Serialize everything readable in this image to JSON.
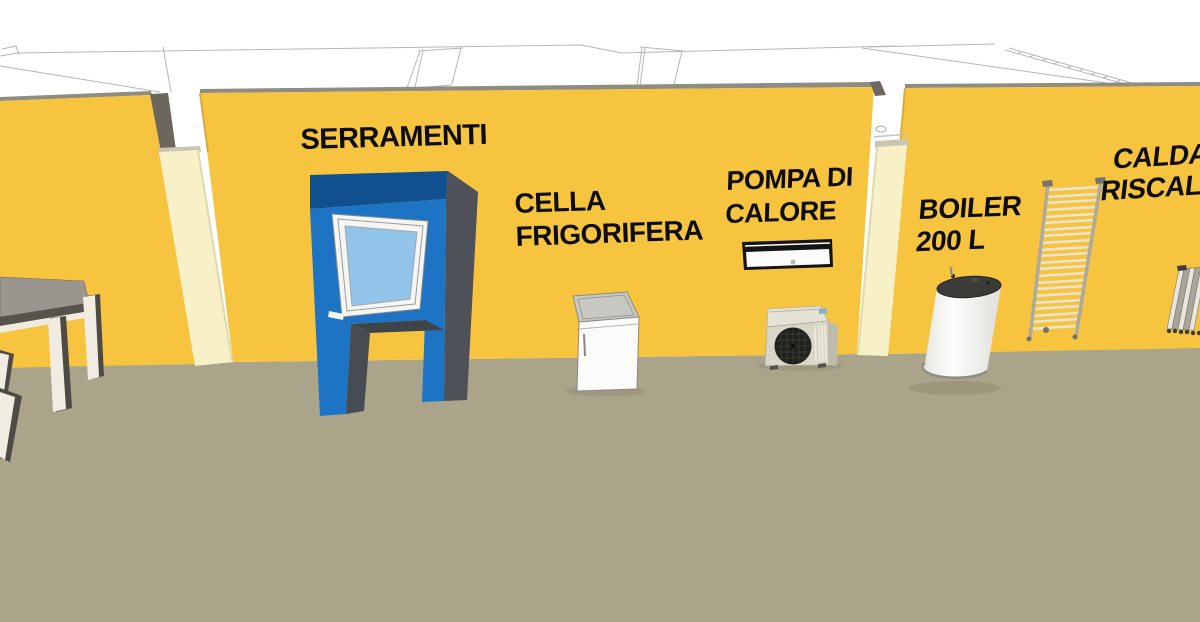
{
  "labels": {
    "serramenti": {
      "line1": "SERRAMENTI"
    },
    "cella_frigorifera": {
      "line1": "CELLA",
      "line2": "FRIGORIFERA"
    },
    "pompa_di_calore": {
      "line1": "POMPA DI",
      "line2": "CALORE"
    },
    "boiler": {
      "line1": "BOILER",
      "line2": "200 L"
    },
    "caldaia_riscaldamento_truncated": {
      "line1": "CALDA",
      "line2": "RISCAL"
    }
  },
  "colors": {
    "background": "#FFFFFF",
    "wall_yellow": "#F7C43F",
    "wall_cap_gray": "#8F8D82",
    "ground_olive": "#AAA48A",
    "pillar_cream": "#F8F1C8",
    "stand_blue_front": "#1E74C4",
    "stand_blue_top": "#11508F",
    "window_glass_blue": "#92C3E9",
    "label_text": "#0D0D0D",
    "roof_outline_gray": "#B6B6B6"
  },
  "scene_objects": [
    "exhibit-table",
    "window-display-stand",
    "cold-room-cabinet",
    "heat-pump-indoor-unit",
    "heat-pump-outdoor-unit",
    "boiler-tank-200l",
    "towel-radiator",
    "column-radiator"
  ]
}
